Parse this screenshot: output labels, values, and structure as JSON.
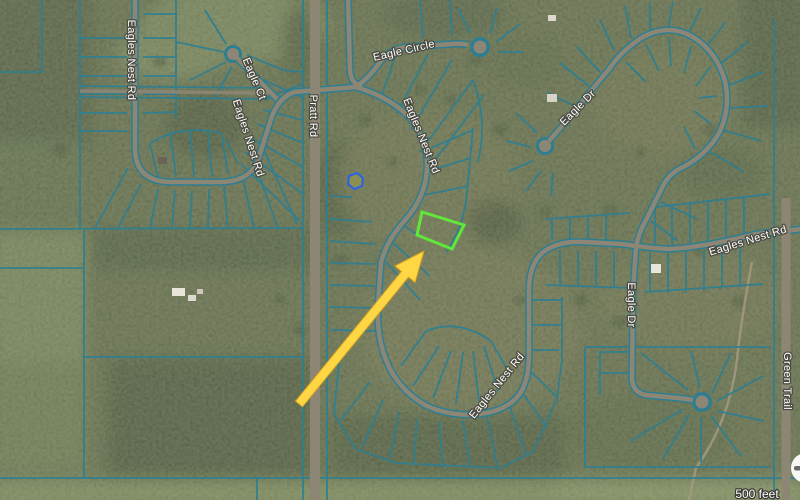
{
  "map": {
    "type": "aerial-parcel-map",
    "road_labels": {
      "eagles_nest_left": "Eagles Nest Rd",
      "eagle_ct": "Eagle Ct",
      "eagles_nest_left_diag": "Eagles Nest Rd",
      "pratt_rd": "Pratt Rd",
      "eagle_circle": "Eagle Circle",
      "eagles_nest_central": "Eagles Nest Rd",
      "eagle_dr_upper": "Eagle Dr",
      "eagle_dr_lower": "Eagle Dr",
      "eagles_nest_bottom": "Eagles Nest Rd",
      "eagles_nest_right": "Eagles Nest Rd",
      "green_trail": "Green Trail"
    },
    "scale_label": "500 feet",
    "zoom_out_label": "−",
    "colors": {
      "parcel_line": "#2e7e91",
      "highlight_parcel": "#5fe83a",
      "arrow": "#ffd643",
      "arrow_edge": "#d9a520",
      "pond_outline": "#2f62e0",
      "road_surface": "#8d8675",
      "label_fill": "#ffffff",
      "label_halo": "#4b4b41"
    }
  }
}
